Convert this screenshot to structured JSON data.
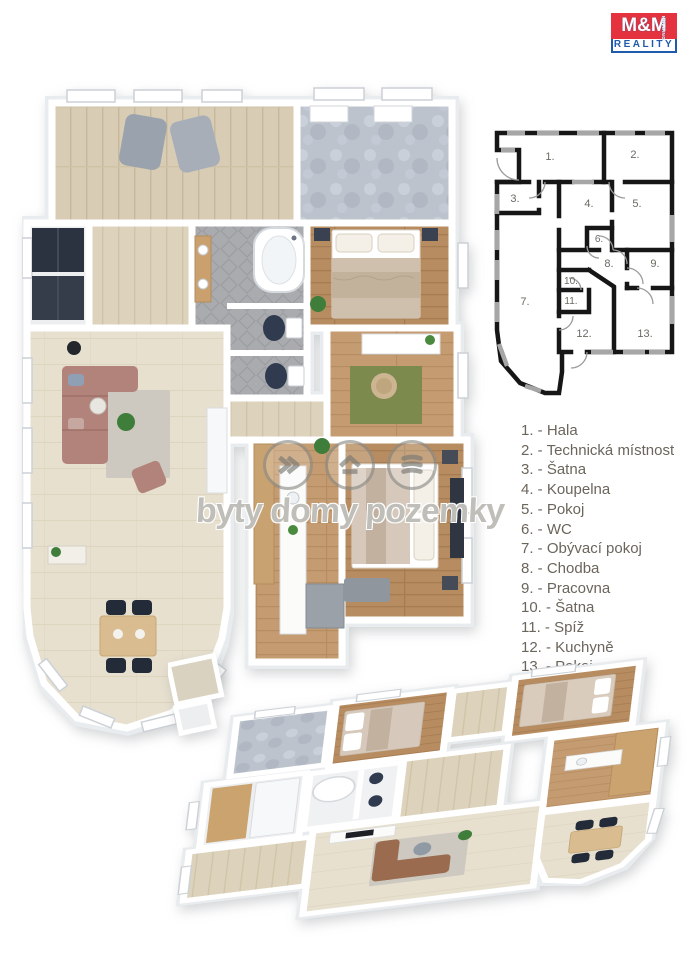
{
  "logo": {
    "brand": "M&M",
    "division": "REALITY",
    "holding": "HOLDING",
    "red": "#e4323e",
    "blue": "#1e5cab"
  },
  "watermark": {
    "text": "byty domy pozemky"
  },
  "legend": {
    "items": [
      {
        "text": "1. - Hala"
      },
      {
        "text": "2. - Technická místnost"
      },
      {
        "text": "3. - Šatna"
      },
      {
        "text": "4. - Koupelna"
      },
      {
        "text": "5. - Pokoj"
      },
      {
        "text": "6. - WC"
      },
      {
        "text": "7. - Obývací pokoj"
      },
      {
        "text": "8. - Chodba"
      },
      {
        "text": "9. - Pracovna"
      },
      {
        "text": "10. - Šatna"
      },
      {
        "text": "11. - Spíž"
      },
      {
        "text": "12. - Kuchyně"
      },
      {
        "text": "13. - Pokoj"
      }
    ]
  },
  "schematic": {
    "rooms": [
      {
        "num": "1."
      },
      {
        "num": "2."
      },
      {
        "num": "3."
      },
      {
        "num": "4."
      },
      {
        "num": "5."
      },
      {
        "num": "6."
      },
      {
        "num": "7."
      },
      {
        "num": "8."
      },
      {
        "num": "9."
      },
      {
        "num": "10."
      },
      {
        "num": "11."
      },
      {
        "num": "12."
      },
      {
        "num": "13."
      }
    ],
    "wall_color": "#161616",
    "window_color": "#a6a6a6",
    "number_color": "#6a6a61"
  },
  "palette": {
    "hall_floor": "#d8cdb4",
    "tech_floor": "#bdc3cd",
    "bath_floor": "#a9abae",
    "bedroom_floor": "#b78c60",
    "living_floor": "#e7e0cf",
    "sofa": "#b2837b",
    "toilet_seat": "#303b50",
    "rug": "#cdc9c0",
    "legend_text": "#6b655c"
  }
}
